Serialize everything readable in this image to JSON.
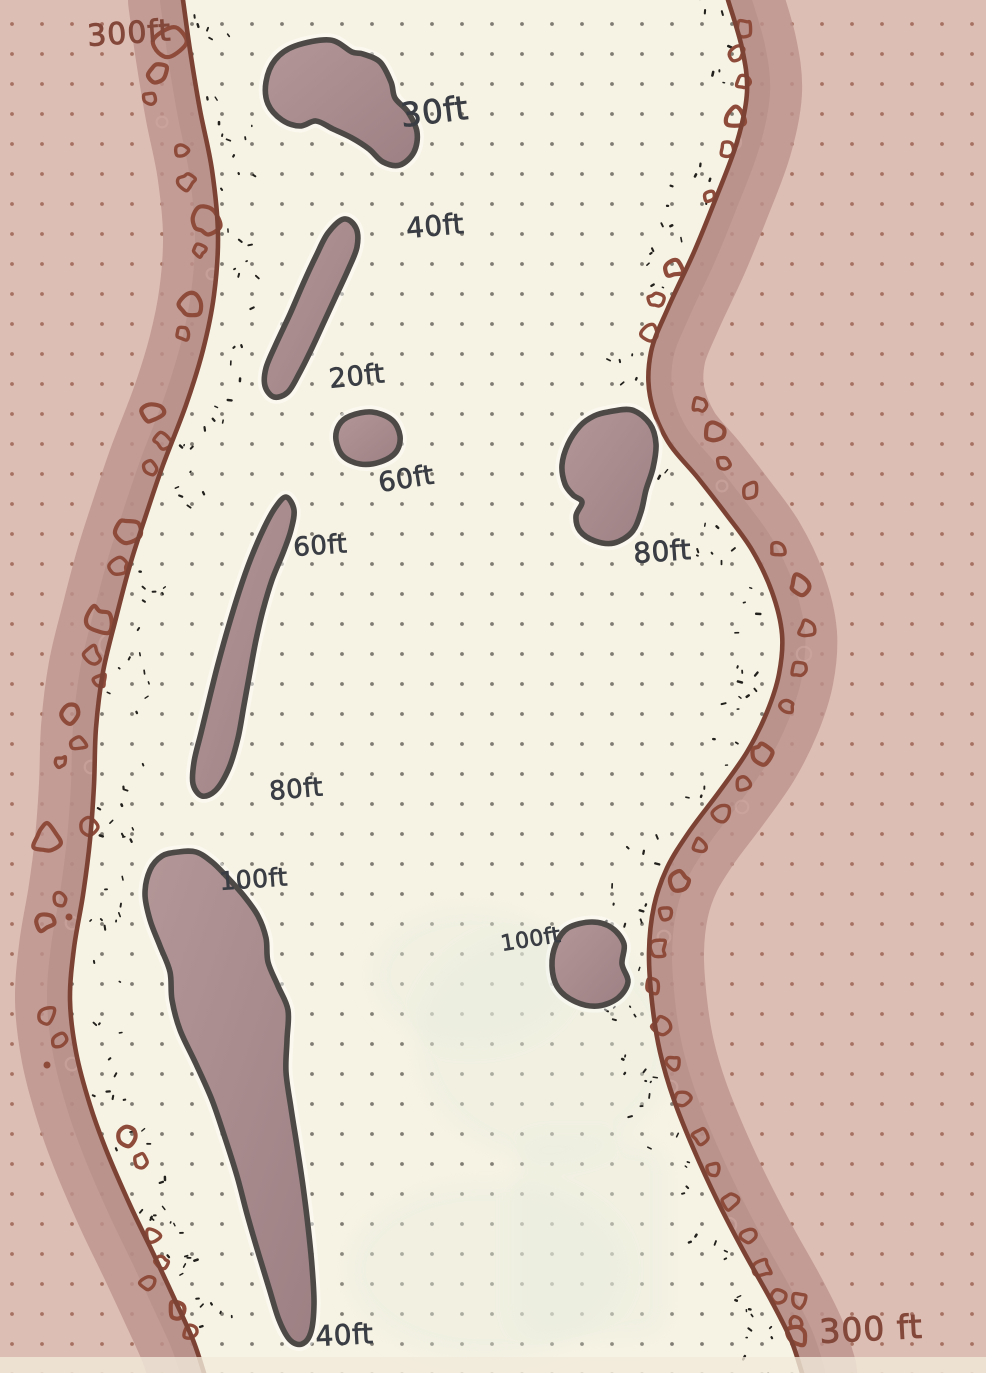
{
  "map": {
    "type": "hand-drawn nautical channel sketch with depth soundings",
    "units": "ft",
    "shore_left_label": "300ft",
    "shore_right_label": "300 ft",
    "depth_labels": [
      "30ft",
      "40ft",
      "20ft",
      "60ft",
      "60ft",
      "80ft",
      "80ft",
      "100ft",
      "100ft",
      "40ft"
    ],
    "colors": {
      "paper_water": "#f7f3e4",
      "shore_fill": "#ddbeb4",
      "shore_band": "#bd948d",
      "shore_band2": "#b28a85",
      "band_ghost": "#cdaaa3",
      "shoreline_ink": "#7c4334",
      "rock_ink": "#8e4b3a",
      "island_fill_light": "#b39798",
      "island_fill_dark": "#9c8083",
      "island_ink": "#4c4946",
      "stipple_ink": "#23211d",
      "depth_ink": "#3a3e44",
      "shore_label_ink": "#84483a",
      "grid_dot": "#5f5b53",
      "grid_dot_shore": "#9c6453",
      "page_edge": "#f1ead9",
      "ghost_tint": "#e6ecdd"
    }
  }
}
